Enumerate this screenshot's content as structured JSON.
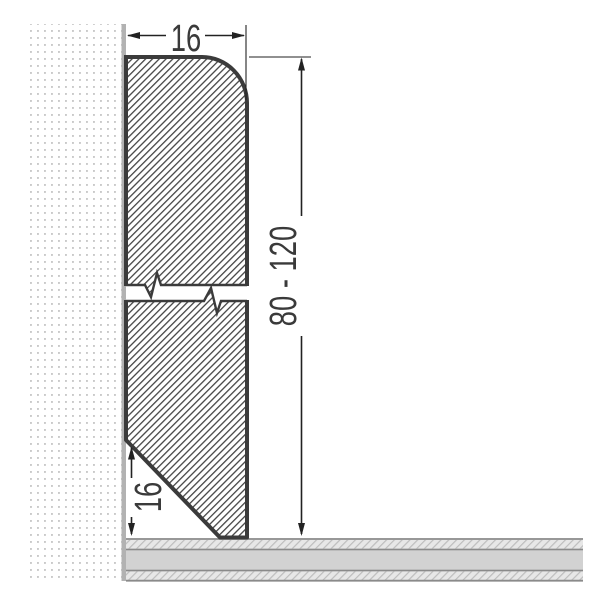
{
  "drawing": {
    "type": "skirting-board-cross-section",
    "dimensions": {
      "width_label": "16",
      "height_label": "80 - 120",
      "chamfer_label": "16"
    },
    "colors": {
      "outline": "#3b3b3b",
      "hatch_line": "#454545",
      "dimension": "#222222",
      "text": "#3a3a3a",
      "wall_dot": "#c9c9c9",
      "wall_edge": "#b2b2b2",
      "floor_line": "#8a8a8a",
      "floor_solid_band": "#d2d2d2",
      "floor_hatch_bg": "#e7e7e7",
      "floor_hatch_line": "#bdbdbd"
    }
  }
}
